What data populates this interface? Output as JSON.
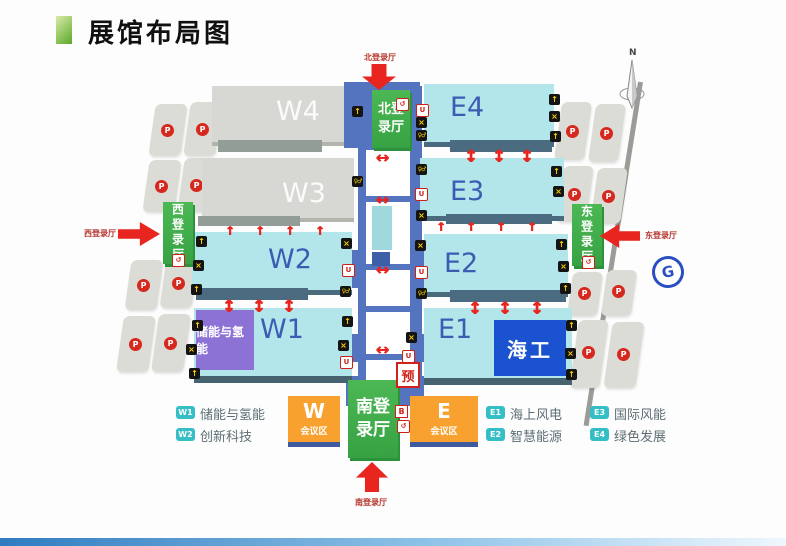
{
  "title": "展馆布局图",
  "compass": {
    "north_label": "N"
  },
  "halls": [
    "W4",
    "W3",
    "W2",
    "W1",
    "E4",
    "E3",
    "E2",
    "E1"
  ],
  "zones": {
    "w1_special": "储能与氢能",
    "e1_special": "海工"
  },
  "entrances": {
    "north": "北登录厅",
    "south": "南登录厅",
    "west": "西登录厅",
    "east": "东登录厅"
  },
  "conference": {
    "west": {
      "letter": "W",
      "label": "会议区"
    },
    "east": {
      "letter": "E",
      "label": "会议区"
    }
  },
  "markers": {
    "parking": "P",
    "reservation": "预",
    "b_service": "B"
  },
  "icon_glyphs": {
    "gate": "↑",
    "dining": "×",
    "restroom": "♀♂",
    "drink": "U",
    "service": "↺",
    "arrow_v": "↕",
    "arrow_h": "↔",
    "arrow_up": "↑",
    "metro": "G"
  },
  "legend": [
    {
      "code": "W1",
      "label": "储能与氢能"
    },
    {
      "code": "W2",
      "label": "创新科技"
    },
    {
      "code": "E1",
      "label": "海上风电"
    },
    {
      "code": "E2",
      "label": "智慧能源"
    },
    {
      "code": "E3",
      "label": "国际风能"
    },
    {
      "code": "E4",
      "label": "绿色发展"
    }
  ],
  "colors": {
    "accent_green": "#5ba829",
    "hall_cyan": "#b2e6ea",
    "hall_gray": "#d7d7d3",
    "entrance_green": "#3fae4b",
    "conference_orange": "#f8a12f",
    "corridor_blue": "#5574c0",
    "zone_purple": "#8d72d6",
    "zone_blue": "#1b52cf",
    "arrow_red": "#e8251f",
    "legend_teal": "#35bec5"
  }
}
